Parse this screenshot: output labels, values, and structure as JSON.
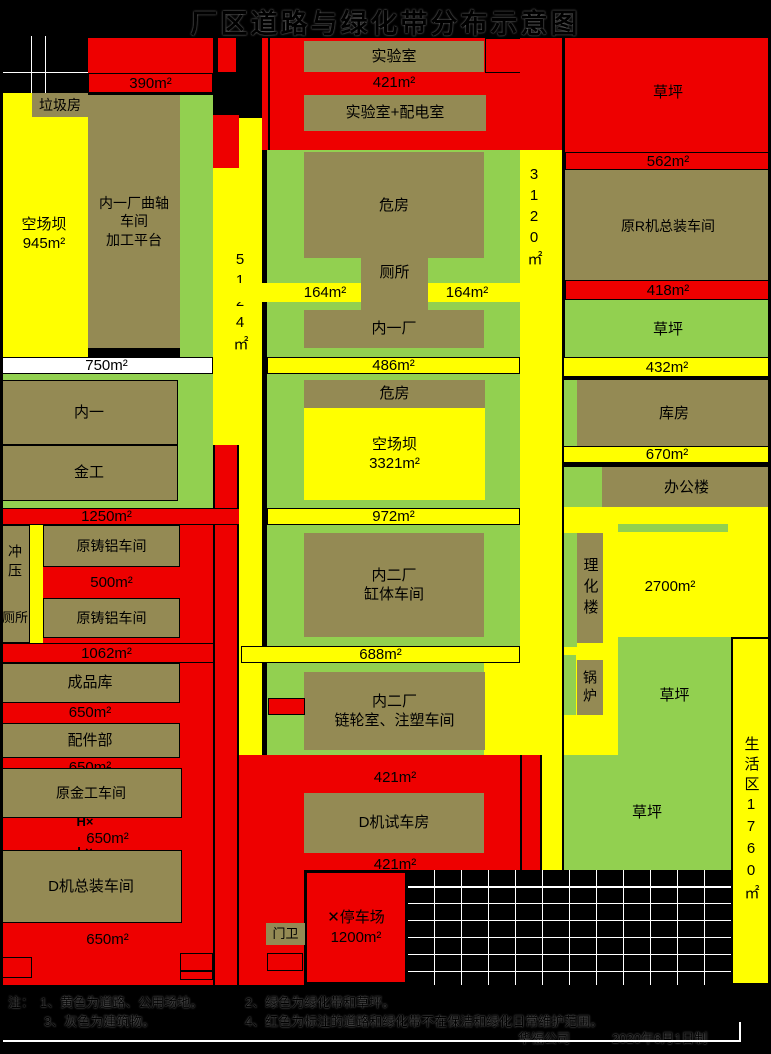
{
  "title": "厂区道路与绿化带分布示意图",
  "colors": {
    "road_yellow": "#ffff00",
    "grass_green": "#92d050",
    "building_olive": "#948a54",
    "planned_red": "#ee0000",
    "background_black": "#000000",
    "bar_white": "#ffffff"
  },
  "labels": {
    "top": {
      "bar_390": "390m²",
      "lab": "实验室",
      "bar_421": "421m²",
      "lab_power": "实验室+配电室",
      "lawn_red": "草坪",
      "bar_562": "562m²"
    },
    "left": {
      "garbage": "垃圾房",
      "yard": "空场坝\n945m²",
      "crank": "内一厂曲轴\n车间\n加工平台",
      "bar_750": "750m²",
      "v_5124": "5124㎡",
      "neiyi": "内一",
      "jingong": "金工",
      "bar_1250": "1250m²",
      "chongya": "冲压",
      "cesuo": "厕所",
      "castal1": "原铸铝车间",
      "bar_500": "500m²",
      "castal2": "原铸铝车间",
      "bar_1062": "1062m²",
      "chengpinku": "成品库",
      "bar_650a": "650m²",
      "peijianbu": "配件部",
      "bar_650b": "650m²",
      "yuanjingong": "原金工车间",
      "hx": "H×",
      "bar_650c": "650m²",
      "lx": "L×",
      "dzong": "D机总装车间",
      "bar_650d": "650m²"
    },
    "center": {
      "weifang1": "危房",
      "cesuo": "厕所",
      "bar_164l": "164m²",
      "bar_164r": "164m²",
      "neiyichang": "内一厂",
      "bar_486": "486m²",
      "weifang2": "危房",
      "yard": "空场坝\n3321m²",
      "bar_972": "972m²",
      "gangti": "内二厂\n缸体车间",
      "bar_688": "688m²",
      "lianlun": "内二厂\n链轮室、注塑车间",
      "bar_421a": "421m²",
      "dtest": "D机试车房",
      "bar_421b": "421m²",
      "menwei": "门卫",
      "parking": "✕停车场\n1200m²",
      "v_3120": "3120㎡"
    },
    "right": {
      "rzong": "原R机总装车间",
      "bar_418": "418m²",
      "lawn1": "草坪",
      "bar_432": "432m²",
      "kufang": "库房",
      "bar_670": "670m²",
      "bangonglou": "办公楼",
      "lihualou": "理化楼",
      "a2700": "2700m²",
      "guolu": "锅炉",
      "lawn2": "草坪",
      "lawn3": "草坪",
      "shenghuo": "生活区1760㎡"
    },
    "notes": {
      "prefix": "注：",
      "n1": "1、黄色为道路、公用场地。",
      "n2": "2、绿色为绿化带和草坪。",
      "n3": "3、灰色为建筑物。",
      "n4": "4、红色为标注的道路和绿化带不在保洁和绿化日常维护范围。",
      "company": "华福公司",
      "date": "2020年6月1日制"
    }
  }
}
